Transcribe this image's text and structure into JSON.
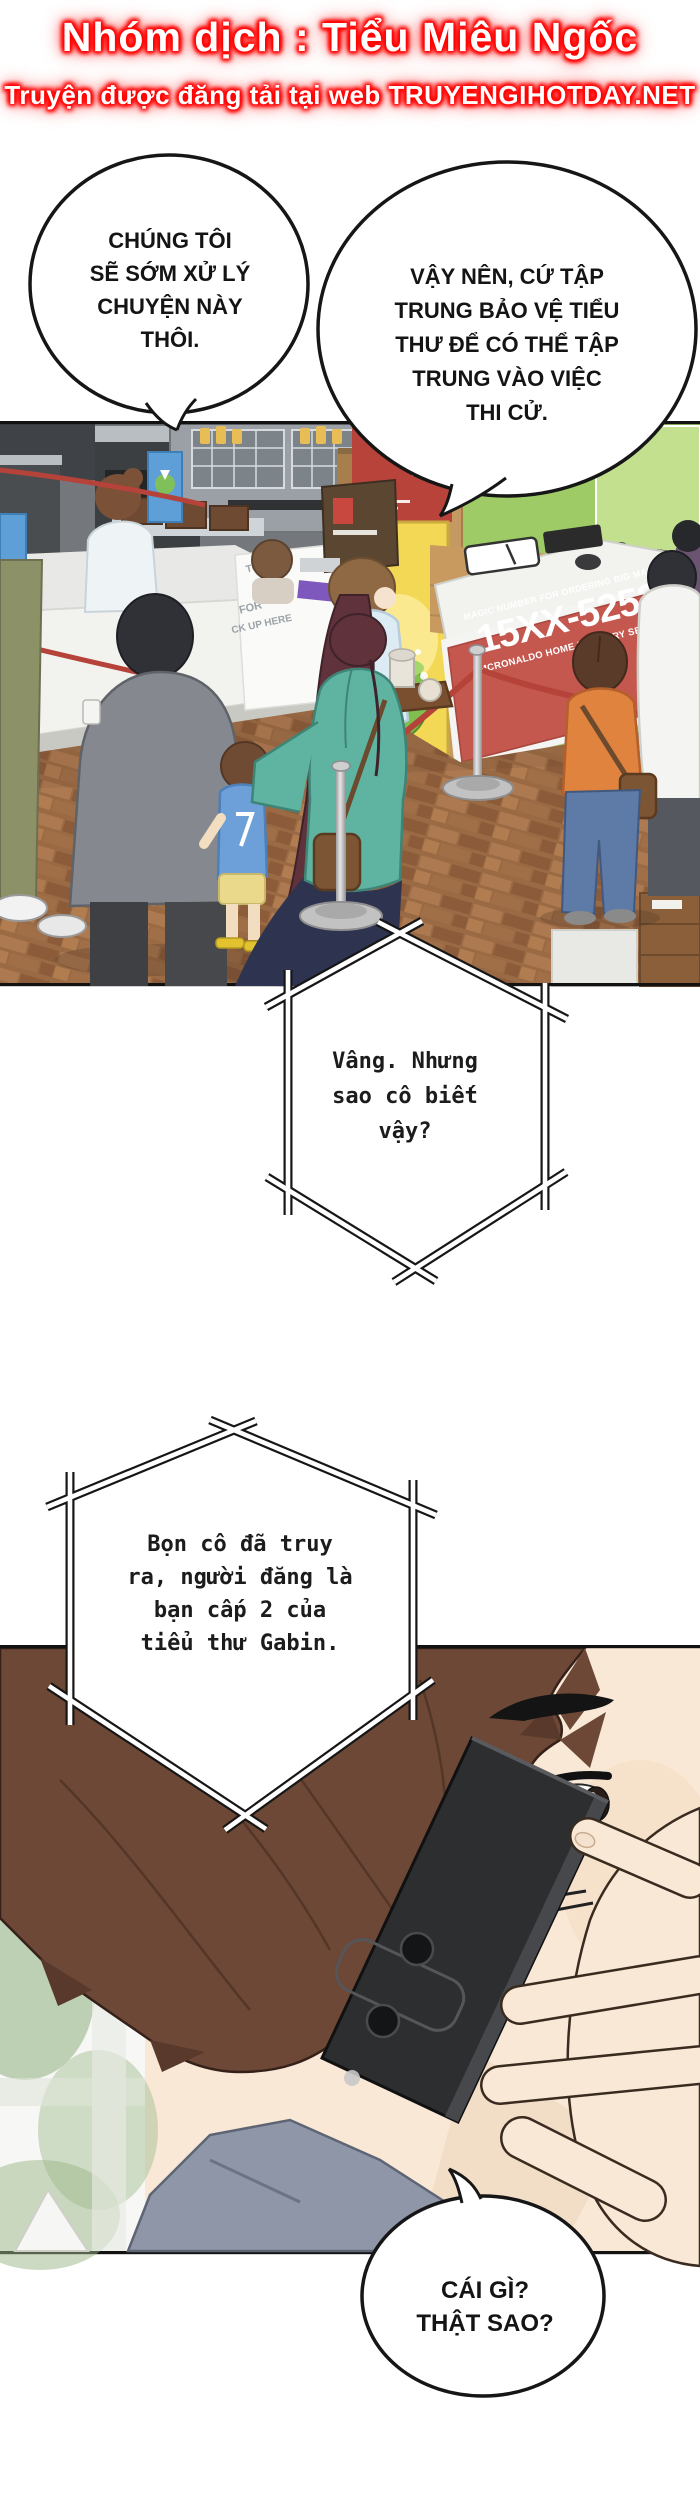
{
  "header": {
    "line1": "Nhóm dịch : Tiểu Miêu Ngốc",
    "line2": "Truyện được đăng tải tại web TRUYENGIHOTDAY.NET"
  },
  "bubbles": {
    "b1": {
      "lines": [
        "CHÚNG TÔI",
        "SẼ SỚM XỬ LÝ",
        "CHUYỆN NÀY",
        "THÔI."
      ]
    },
    "b2": {
      "lines": [
        "VẬY NÊN, CỨ TẬP",
        "TRUNG BẢO VỆ TIỂU",
        "THƯ ĐỂ CÓ THỂ TẬP",
        "TRUNG VÀO VIỆC",
        "THI CỬ."
      ]
    },
    "hex1": {
      "lines": [
        "Vâng. Nhưng",
        "sao cô biết",
        "vậy?"
      ]
    },
    "hex2": {
      "lines": [
        "Bọn cô đã truy",
        "ra, người đăng là",
        "bạn cấp 2 của",
        "tiểu thư Gabin."
      ]
    },
    "b3": {
      "lines": [
        "CÁI GÌ?",
        "THẬT SAO?"
      ]
    }
  },
  "panel1": {
    "counter_sign": {
      "top": "MAGIC NUMBER FOR ORDERING BIG MACS",
      "number": "15XX-5252",
      "bottom": "MCRONALDO HOME DELIVERY SERVICE"
    },
    "wall_text_fragments": [
      "TO",
      "FOR",
      "CK UP HERE"
    ]
  },
  "colors": {
    "glow_red": "#ff1a1a",
    "sign_red": "#c4574e",
    "wall_green": "#9ecb66",
    "jacket_teal": "#5fb3a1",
    "rope_red": "#b5433a"
  }
}
